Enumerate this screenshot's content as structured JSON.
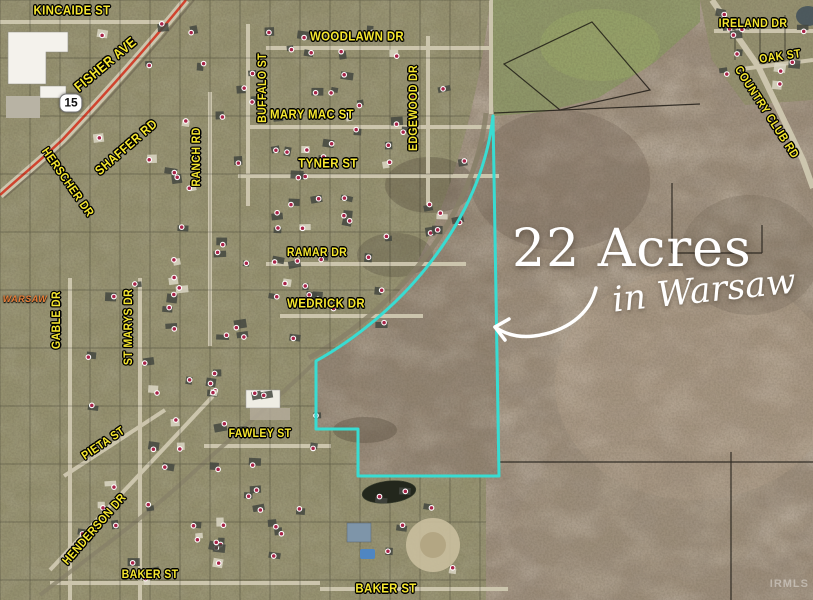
{
  "image_type": "aerial-property-listing",
  "callout": {
    "headline": "22 Acres",
    "subheadline": "in Warsaw"
  },
  "highway_shield": {
    "label": "15"
  },
  "city_label": {
    "text": "WARSAW"
  },
  "watermark": {
    "text": "IRMLS"
  },
  "colors": {
    "boundary": "#38dcd2",
    "street_label": "#f6e72f",
    "highway_line": "#d0432e",
    "city_label": "#e8803a",
    "callout_text": "#ffffff"
  },
  "street_labels": [
    {
      "id": "kincaide-st",
      "text": "KINCAIDE ST",
      "x": 72,
      "y": 10,
      "rot": 0,
      "size": 13
    },
    {
      "id": "woodlawn-dr",
      "text": "WOODLAWN DR",
      "x": 357,
      "y": 36,
      "rot": 0,
      "size": 13
    },
    {
      "id": "ireland-dr",
      "text": "IRELAND DR",
      "x": 753,
      "y": 23,
      "rot": 0,
      "size": 12
    },
    {
      "id": "oak-st",
      "text": "OAK ST",
      "x": 780,
      "y": 56,
      "rot": -8,
      "size": 12
    },
    {
      "id": "country-club-rd",
      "text": "COUNTRY CLUB RD",
      "x": 767,
      "y": 112,
      "rot": 57,
      "size": 12
    },
    {
      "id": "fisher-ave",
      "text": "FISHER AVE",
      "x": 105,
      "y": 64,
      "rot": -40,
      "size": 14
    },
    {
      "id": "buffalo-st",
      "text": "BUFFALO ST",
      "x": 262,
      "y": 88,
      "rot": -90,
      "size": 12
    },
    {
      "id": "mary-mac-st",
      "text": "MARY MAC ST",
      "x": 312,
      "y": 114,
      "rot": 0,
      "size": 13
    },
    {
      "id": "edgewood-dr",
      "text": "EDGEWOOD DR",
      "x": 413,
      "y": 108,
      "rot": -90,
      "size": 12
    },
    {
      "id": "shaffer-rd",
      "text": "SHAFFER RD",
      "x": 126,
      "y": 147,
      "rot": -41,
      "size": 13
    },
    {
      "id": "ranch-rd",
      "text": "RANCH RD",
      "x": 196,
      "y": 157,
      "rot": -90,
      "size": 12
    },
    {
      "id": "tyner-st",
      "text": "TYNER ST",
      "x": 328,
      "y": 163,
      "rot": 0,
      "size": 13
    },
    {
      "id": "herscher-dr",
      "text": "HERSCHER DR",
      "x": 68,
      "y": 182,
      "rot": 55,
      "size": 12
    },
    {
      "id": "ramar-dr",
      "text": "RAMAR DR",
      "x": 317,
      "y": 252,
      "rot": 0,
      "size": 12
    },
    {
      "id": "wedrick-dr",
      "text": "WEDRICK DR",
      "x": 326,
      "y": 303,
      "rot": 0,
      "size": 13
    },
    {
      "id": "gable-dr",
      "text": "GABLE DR",
      "x": 56,
      "y": 320,
      "rot": -90,
      "size": 12
    },
    {
      "id": "st-marys-dr",
      "text": "ST MARYS DR",
      "x": 128,
      "y": 327,
      "rot": -90,
      "size": 12
    },
    {
      "id": "pieta-st",
      "text": "PIETA ST",
      "x": 103,
      "y": 443,
      "rot": -34,
      "size": 12
    },
    {
      "id": "fawley-st",
      "text": "FAWLEY ST",
      "x": 260,
      "y": 433,
      "rot": 0,
      "size": 12
    },
    {
      "id": "henderson-dr",
      "text": "HENDERSON DR",
      "x": 94,
      "y": 529,
      "rot": -49,
      "size": 12
    },
    {
      "id": "baker-st-west",
      "text": "BAKER ST",
      "x": 150,
      "y": 574,
      "rot": 0,
      "size": 12
    },
    {
      "id": "baker-st-east",
      "text": "BAKER ST",
      "x": 386,
      "y": 588,
      "rot": 0,
      "size": 13
    }
  ]
}
